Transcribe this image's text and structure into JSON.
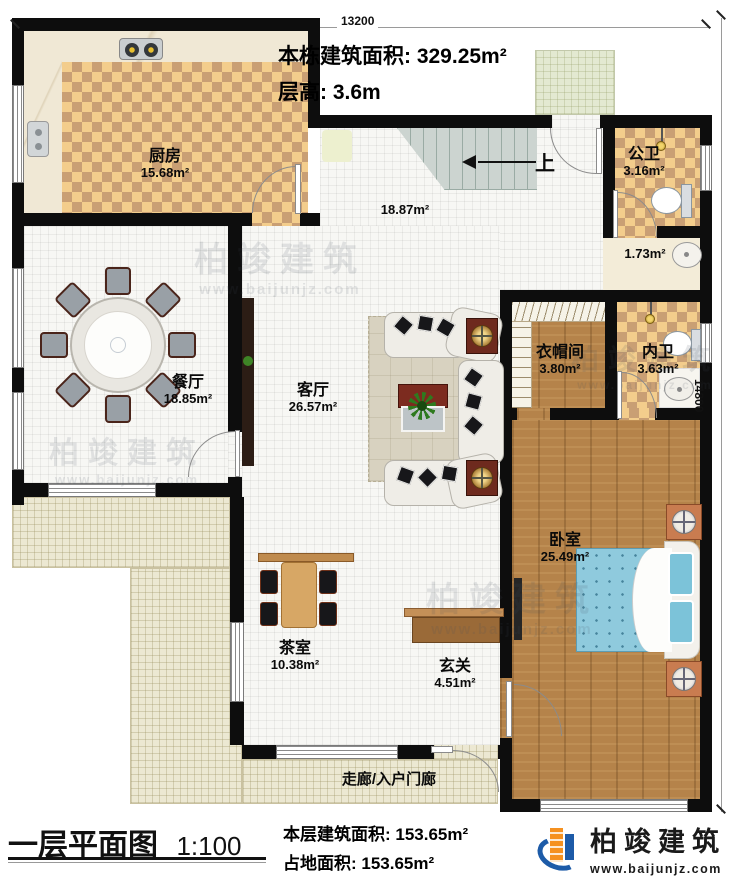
{
  "page": {
    "background": "#ffffff"
  },
  "dimensions": {
    "top": "13200",
    "right": "14800"
  },
  "header": {
    "line1": "本栋建筑面积: 329.25m²",
    "line2": "层高: 3.6m"
  },
  "rooms": [
    {
      "name": "厨房",
      "area": "15.68m²"
    },
    {
      "name": "公卫",
      "area": "3.16m²"
    },
    {
      "name": "餐厅",
      "area": "18.85m²"
    },
    {
      "name": "客厅",
      "area": "26.57m²"
    },
    {
      "name": "衣帽间",
      "area": "3.80m²"
    },
    {
      "name": "内卫",
      "area": "3.63m²"
    },
    {
      "name": "卧室",
      "area": "25.49m²"
    },
    {
      "name": "茶室",
      "area": "10.38m²"
    },
    {
      "name": "玄关",
      "area": "4.51m²"
    },
    {
      "name": "走廊/入户门廊",
      "area": ""
    }
  ],
  "annotations": {
    "stair_hall_area": "18.87m²",
    "vanity_area": "1.73m²",
    "stairs_up": "上"
  },
  "footer": {
    "title": "一层平面图",
    "scale": "1:100",
    "line1": "本层建筑面积: 153.65m²",
    "line2": "占地面积: 153.65m²"
  },
  "logo": {
    "name": "柏竣建筑",
    "url": "www.baijunjz.com"
  },
  "watermark": {
    "brand": "柏竣建筑",
    "url": "www.baijunjz.com"
  },
  "colors": {
    "wall": "#0d0d0d",
    "checker_dark": "#c99f74",
    "checker_light": "#f3cd8c",
    "wood": "#b5834a",
    "tile_beige": "#ece8d2",
    "bed_blue": "#8fcadd",
    "logo_blue": "#1d5ba8",
    "logo_orange": "#f59120"
  }
}
